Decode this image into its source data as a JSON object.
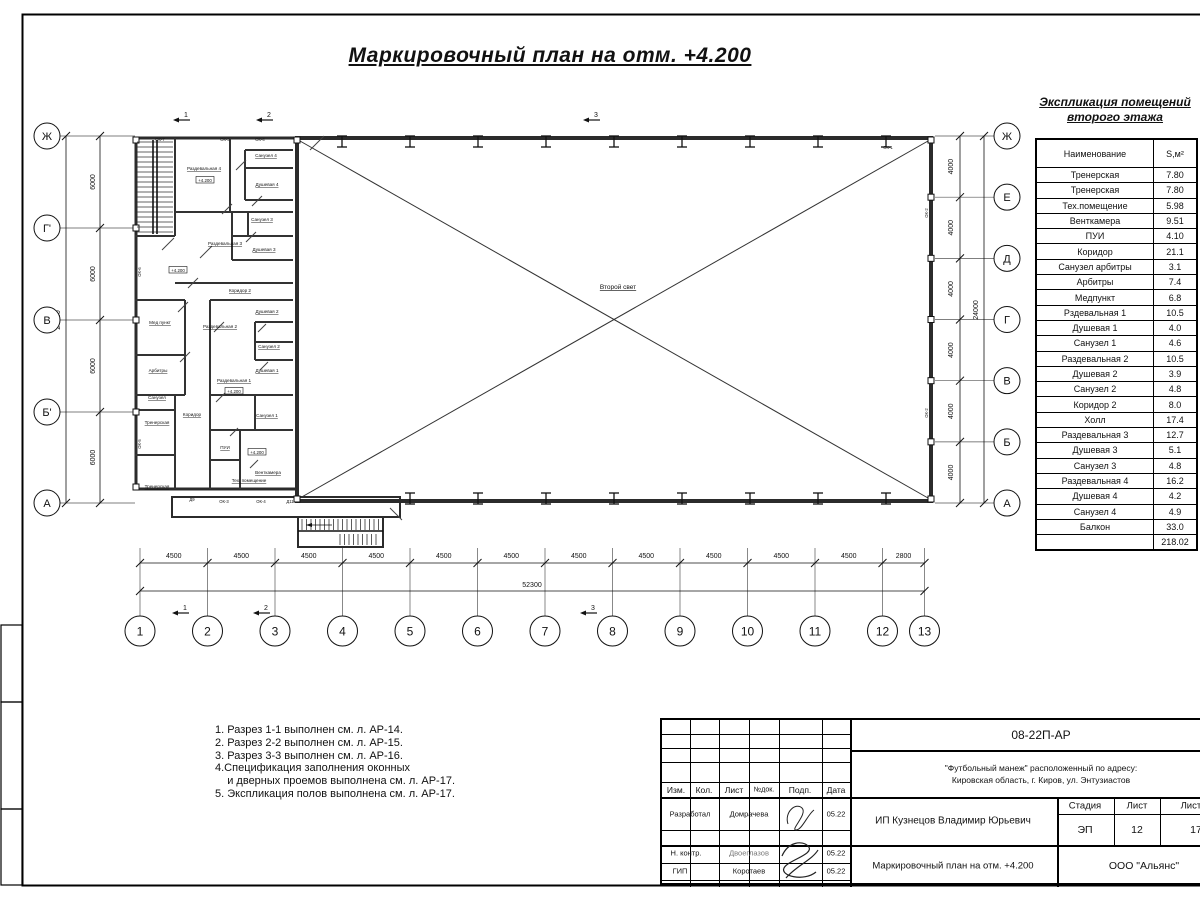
{
  "title": "Маркировочный план на отм. +4.200",
  "explication": {
    "title_line1": "Экспликация помещений",
    "title_line2": "второго этажа",
    "header": {
      "name": "Наименование",
      "area": "S,м²"
    },
    "rows": [
      [
        "Тренерская",
        "7.80"
      ],
      [
        "Тренерская",
        "7.80"
      ],
      [
        "Тех.помещение",
        "5.98"
      ],
      [
        "Венткамера",
        "9.51"
      ],
      [
        "ПУИ",
        "4.10"
      ],
      [
        "Коридор",
        "21.1"
      ],
      [
        "Санузел арбитры",
        "3.1"
      ],
      [
        "Арбитры",
        "7.4"
      ],
      [
        "Медпункт",
        "6.8"
      ],
      [
        "Рздевальная 1",
        "10.5"
      ],
      [
        "Душевая 1",
        "4.0"
      ],
      [
        "Санузел 1",
        "4.6"
      ],
      [
        "Раздевальная 2",
        "10.5"
      ],
      [
        "Душевая 2",
        "3.9"
      ],
      [
        "Санузел 2",
        "4.8"
      ],
      [
        "Коридор 2",
        "8.0"
      ],
      [
        "Холл",
        "17.4"
      ],
      [
        "Раздевальная 3",
        "12.7"
      ],
      [
        "Душевая 3",
        "5.1"
      ],
      [
        "Санузел 3",
        "4.8"
      ],
      [
        "Раздевальная 4",
        "16.2"
      ],
      [
        "Душевая 4",
        "4.2"
      ],
      [
        "Санузел 4",
        "4.9"
      ],
      [
        "Балкон",
        "33.0"
      ],
      [
        "",
        "218.02"
      ]
    ]
  },
  "notes": [
    "1. Разрез 1-1 выполнен см. л. АР-14.",
    "2. Разрез 2-2 выполнен см. л. АР-15.",
    "3. Разрез 3-3 выполнен см. л. АР-16.",
    "4.Спецификация заполнения оконных",
    "    и дверных проемов выполнена см. л. АР-17.",
    "5. Экспликация полов выполнена см. л. АР-17."
  ],
  "titleblock": {
    "code": "08-22П-АР",
    "address_line1": "\"Футбольный манеж\" расположенный по адресу:",
    "address_line2": "Кировская область, г. Киров, ул. Энтузиастов",
    "client": "ИП Кузнецов Владимир Юрьевич",
    "columns": [
      "Изм.",
      "Кол.",
      "Лист",
      "№док.",
      "Подп.",
      "Дата"
    ],
    "stage_label": "Стадия",
    "sheet_label": "Лист",
    "sheets_label": "Листов",
    "stage": "ЭП",
    "sheet": "12",
    "sheets": "17",
    "doc_title": "Маркировочный план на отм. +4.200",
    "company": "ООО \"Альянс\"",
    "rows": [
      {
        "role": "Разработал",
        "name": "Домрачева",
        "date": "05.22"
      },
      {
        "role": "Н. контр.",
        "name": "Двоеглазов",
        "date": "05.22"
      },
      {
        "role": "ГИП",
        "name": "Коротаев",
        "date": "05.22"
      }
    ]
  },
  "plan": {
    "axes": {
      "left": [
        "Ж",
        "Г'",
        "В",
        "Б'",
        "А"
      ],
      "right": [
        "Ж",
        "Е",
        "Д",
        "Г",
        "В",
        "Б",
        "А"
      ],
      "bottom": [
        "1",
        "2",
        "3",
        "4",
        "5",
        "6",
        "7",
        "8",
        "9",
        "10",
        "11",
        "12",
        "13"
      ]
    },
    "dims": {
      "left_segments": [
        "6000",
        "6000",
        "6000",
        "6000"
      ],
      "left_total": "24000",
      "right_segments": [
        "4000",
        "4000",
        "4000",
        "4000",
        "4000",
        "4000"
      ],
      "right_total": "24000",
      "bottom_segments": [
        "4500",
        "4500",
        "4500",
        "4500",
        "4500",
        "4500",
        "4500",
        "4500",
        "4500",
        "4500",
        "4500",
        "2800"
      ],
      "bottom_total": "52300"
    },
    "section_markers": [
      "1",
      "2",
      "3"
    ],
    "hall_label": "Второй свет",
    "rooms": [
      "Раздевальная 4",
      "Санузел 4",
      "Душевая 4",
      "Санузел 3",
      "Раздевальная 3",
      "Душевая 3",
      "Коридор 2",
      "Мед пункт",
      "Душевая 2",
      "Раздевальная 2",
      "Санузел 2",
      "Арбитры",
      "Душевая 1",
      "Раздевальная 1",
      "Санузел",
      "Коридор",
      "Санузел 1",
      "Тренерская",
      "ПУИ",
      "Венткамера",
      "Тех. помещение",
      "Тренерская"
    ],
    "levels": [
      "+4.200",
      "+4.200",
      "+4.200",
      "+4.200"
    ],
    "tags": [
      "ОК-7",
      "ОК-3",
      "ОК-4",
      "ОК-1",
      "ОК-6",
      "ОК-5",
      "Д9",
      "ОК-3",
      "ОК-4",
      "Д11",
      "ОК-2",
      "ОК-2"
    ]
  }
}
